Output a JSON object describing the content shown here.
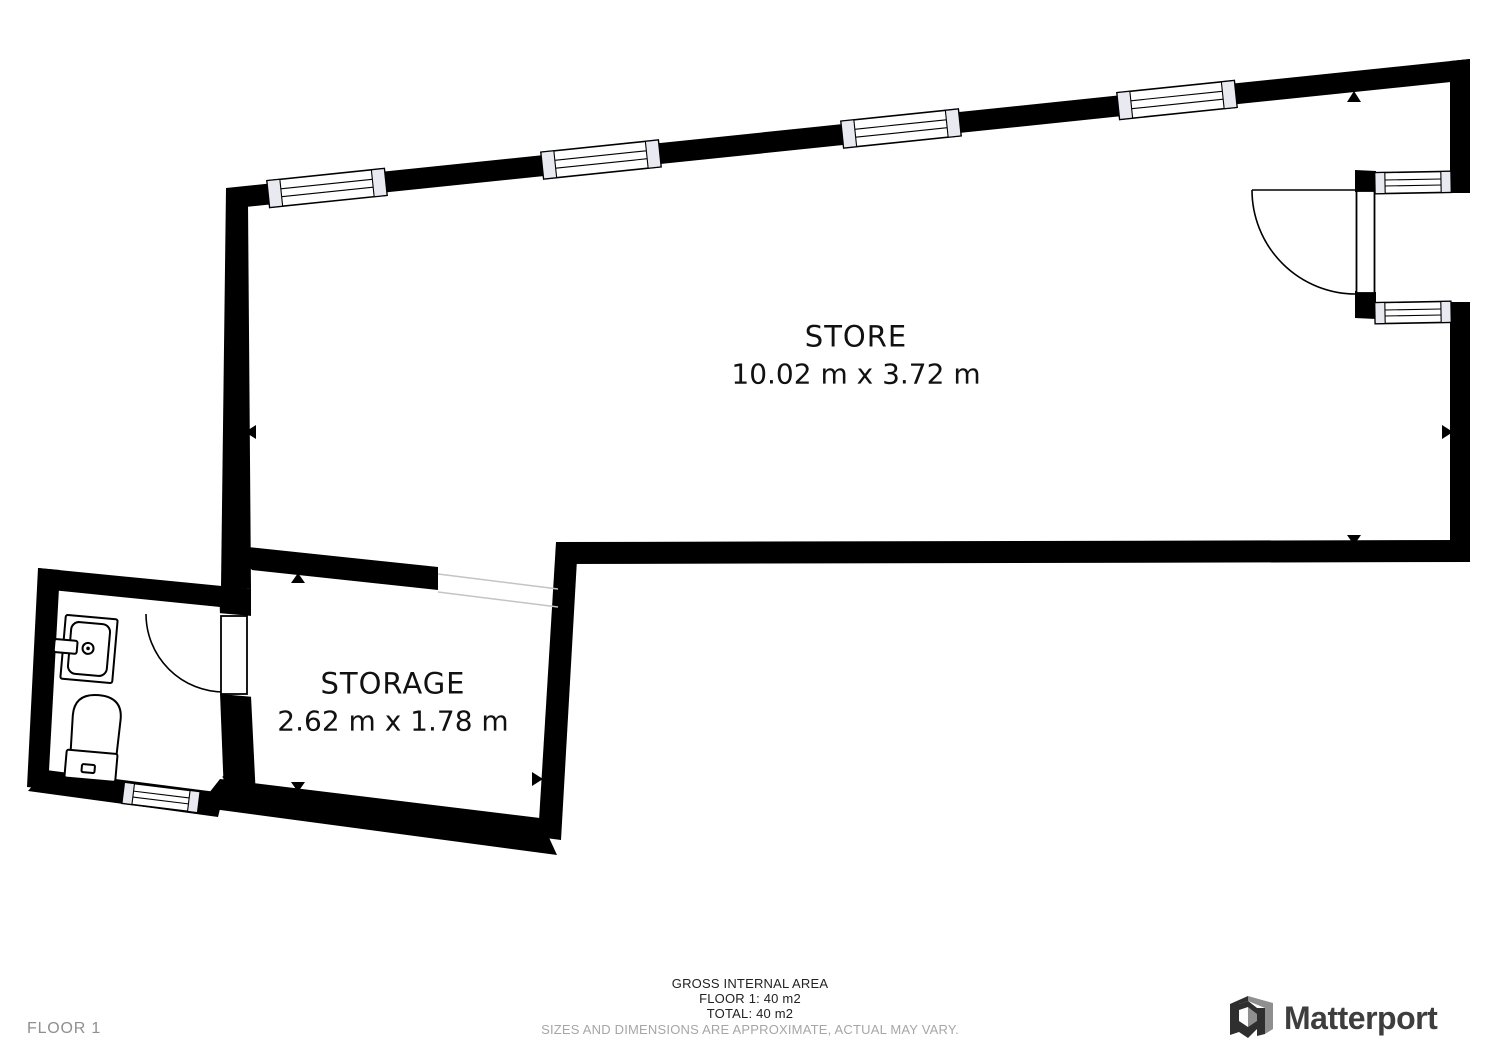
{
  "floorplan": {
    "rooms": [
      {
        "name": "STORE",
        "dimensions": "10.02 m x 3.72 m"
      },
      {
        "name": "STORAGE",
        "dimensions": "2.62 m x 1.78 m"
      }
    ],
    "floor_label": "FLOOR 1",
    "area_summary": {
      "title": "GROSS INTERNAL AREA",
      "floor_line": "FLOOR 1: 40 m2",
      "total_line": "TOTAL: 40 m2",
      "disclaimer": "SIZES AND DIMENSIONS ARE APPROXIMATE, ACTUAL MAY VARY."
    },
    "brand": {
      "name": "Matterport"
    },
    "colors": {
      "wall": "#000000",
      "window_fill": "#e9e9f2",
      "passage_line": "#c4c4c8",
      "label_text": "#111111",
      "muted_text": "#a6a6a6",
      "floor_label_text": "#8f8f8f",
      "brand_text": "#3e3e3e",
      "logo_dark": "#2f2f2f",
      "logo_gray": "#8f8f8f"
    }
  }
}
